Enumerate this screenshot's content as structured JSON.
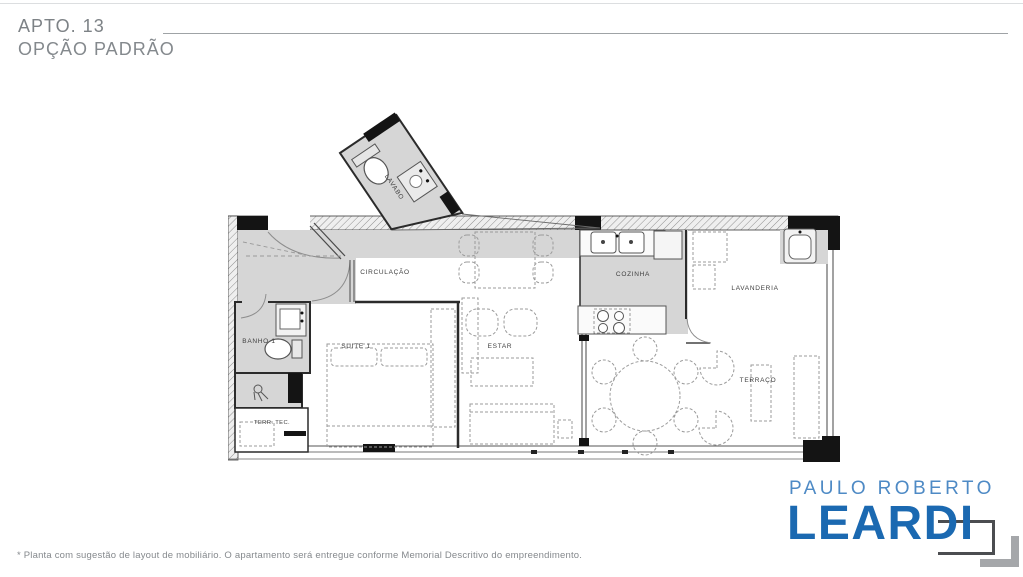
{
  "header": {
    "apt_label": "APTO. 13",
    "option_label": "OPÇÃO PADRÃO"
  },
  "plan": {
    "rooms": [
      {
        "id": "lavabo",
        "label": "LAVABO"
      },
      {
        "id": "circulacao",
        "label": "CIRCULAÇÃO"
      },
      {
        "id": "cozinha",
        "label": "COZINHA"
      },
      {
        "id": "lavanderia",
        "label": "LAVANDERIA"
      },
      {
        "id": "banho1",
        "label": "BANHO 1"
      },
      {
        "id": "suite1",
        "label": "SUITE 1"
      },
      {
        "id": "estar",
        "label": "ESTAR"
      },
      {
        "id": "terraco",
        "label": "TERRAÇO"
      },
      {
        "id": "terr_tec",
        "label": "TERR. TEC."
      }
    ]
  },
  "logo": {
    "line1": "PAULO ROBERTO",
    "line2": "LEARDI"
  },
  "footer": {
    "disclaimer": "* Planta com sugestão de layout de mobiliário. O apartamento será entregue conforme Memorial Descritivo do empreendimento."
  },
  "colors": {
    "logo_light_blue": "#4e8ac5",
    "logo_dark_blue": "#1b69b1",
    "title_gray": "#7d8286",
    "floor_gray": "#d6d6d6",
    "wall_dark": "#2b2b2b"
  }
}
